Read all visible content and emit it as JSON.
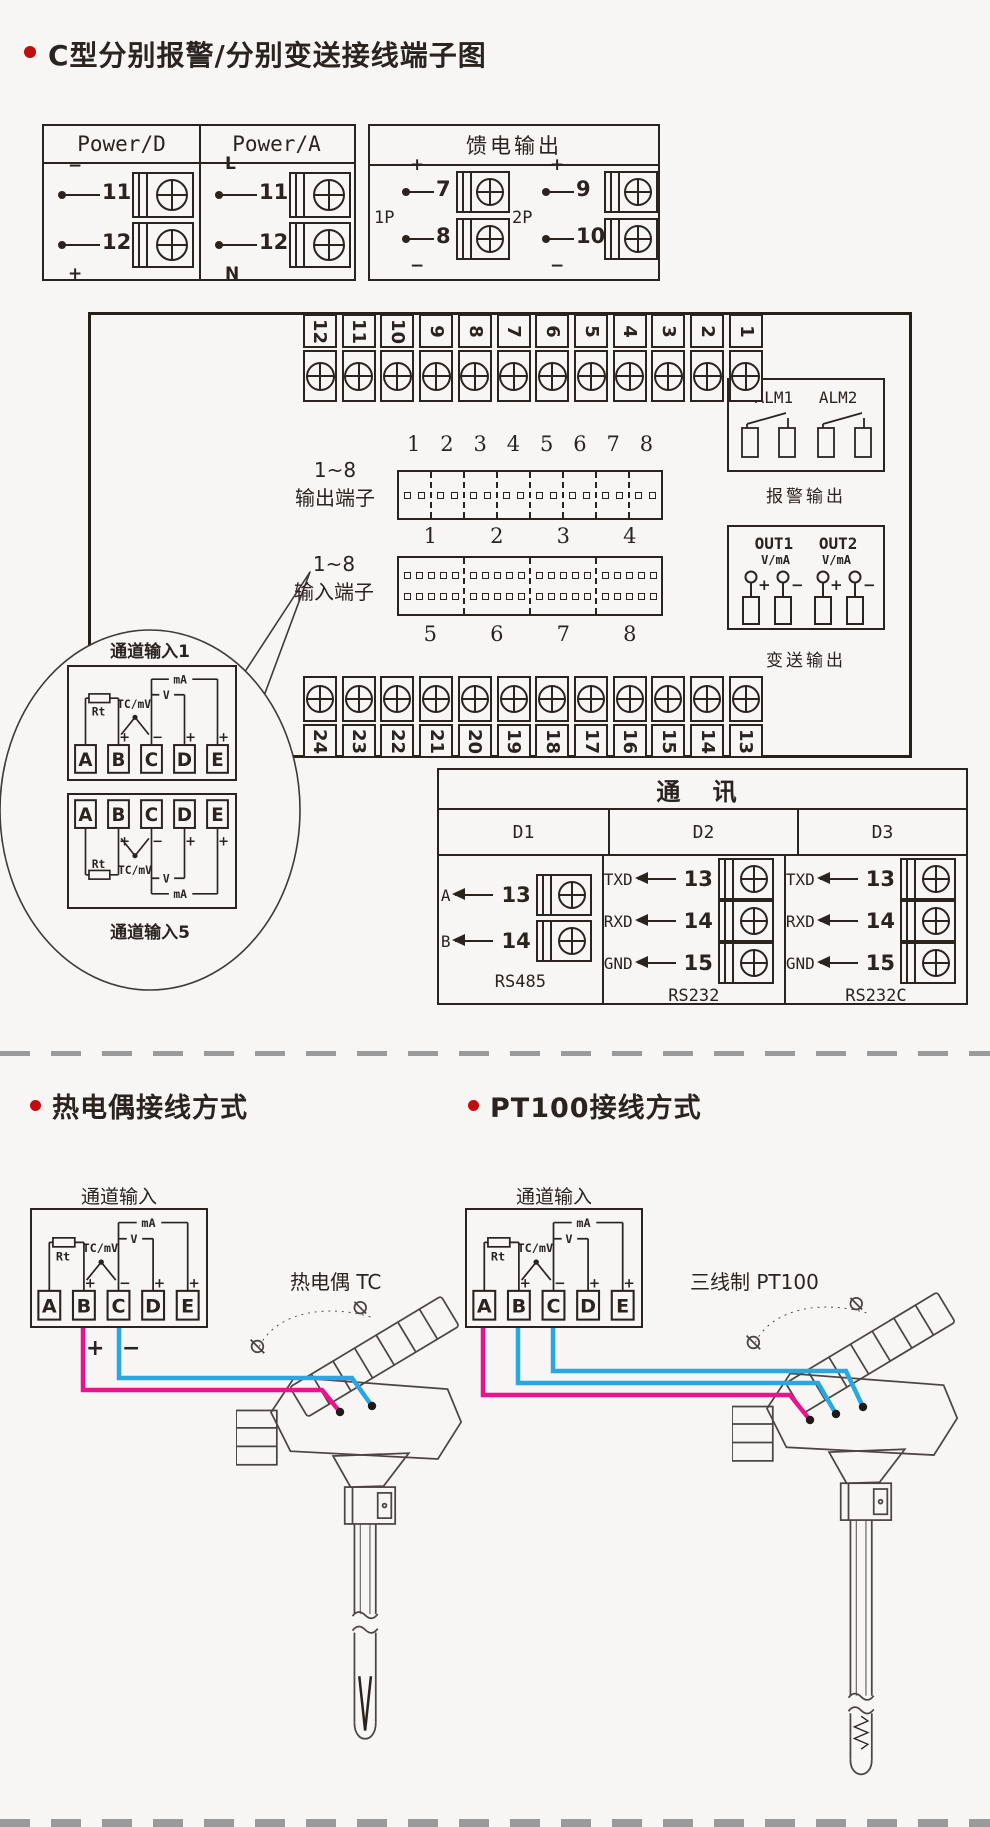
{
  "colors": {
    "accent_red": "#c00d0d",
    "wire_pink": "#ec118c",
    "wire_blue": "#29a7e0",
    "line": "#2b2320",
    "bg": "#f7f6f4"
  },
  "s1": {
    "title": "C型分别报警/分别变送接线端子图",
    "power": {
      "cols": [
        {
          "header": "Power/D",
          "rows": [
            {
              "sign": "−",
              "num": "11"
            },
            {
              "sign": "+",
              "num": "12"
            }
          ]
        },
        {
          "header": "Power/A",
          "rows": [
            {
              "sign": "L",
              "num": "11"
            },
            {
              "sign": "N",
              "num": "12"
            }
          ]
        }
      ]
    },
    "feed": {
      "header": "馈电输出",
      "groups": [
        {
          "label": "1P",
          "rows": [
            {
              "sign": "+",
              "num": "7"
            },
            {
              "sign": "−",
              "num": "8"
            }
          ]
        },
        {
          "label": "2P",
          "rows": [
            {
              "sign": "+",
              "num": "9"
            },
            {
              "sign": "−",
              "num": "10"
            }
          ]
        }
      ]
    },
    "top_strip": [
      "12",
      "11",
      "10",
      "9",
      "8",
      "7",
      "6",
      "5",
      "4",
      "3",
      "2",
      "1"
    ],
    "bottom_strip": [
      "24",
      "23",
      "22",
      "21",
      "20",
      "19",
      "18",
      "17",
      "16",
      "15",
      "14",
      "13"
    ],
    "out_block": {
      "l1": "1~8",
      "l2": "输出端子",
      "nums": [
        "1",
        "2",
        "3",
        "4",
        "5",
        "6",
        "7",
        "8"
      ]
    },
    "in_block": {
      "l1": "1~8",
      "l2": "输入端子",
      "top": [
        "1",
        "2",
        "3",
        "4"
      ],
      "bottom": [
        "5",
        "6",
        "7",
        "8"
      ]
    },
    "alarm": {
      "a1": "ALM1",
      "a2": "ALM2",
      "caption": "报警输出"
    },
    "xmit": {
      "o1": "OUT1",
      "o2": "OUT2",
      "vma": "V/mA",
      "plus": "+",
      "minus": "−",
      "caption": "变送输出"
    },
    "balloon": {
      "top_label": "通道输入1",
      "bottom_label": "通道输入5"
    },
    "detail": {
      "t": [
        "A",
        "B",
        "C",
        "D",
        "E"
      ],
      "rt": "Rt",
      "tc": "TC/mV",
      "v": "V",
      "ma": "mA",
      "plus": "+",
      "minus": "−"
    },
    "comm": {
      "title": "通  讯",
      "cols": [
        {
          "name": "D1",
          "caption": "RS485",
          "rows": [
            {
              "label": "A",
              "num": "13"
            },
            {
              "label": "B",
              "num": "14"
            }
          ]
        },
        {
          "name": "D2",
          "caption": "RS232",
          "rows": [
            {
              "label": "TXD",
              "num": "13"
            },
            {
              "label": "RXD",
              "num": "14"
            },
            {
              "label": "GND",
              "num": "15"
            }
          ]
        },
        {
          "name": "D3",
          "caption": "RS232C",
          "rows": [
            {
              "label": "TXD",
              "num": "13"
            },
            {
              "label": "RXD",
              "num": "14"
            },
            {
              "label": "GND",
              "num": "15"
            }
          ]
        }
      ]
    }
  },
  "s2": {
    "left": {
      "title": "热电偶接线方式",
      "channel": "通道输入",
      "sensor": "热电偶 TC",
      "plus": "+",
      "minus": "−"
    },
    "right": {
      "title": "PT100接线方式",
      "channel": "通道输入",
      "sensor": "三线制 PT100"
    }
  }
}
